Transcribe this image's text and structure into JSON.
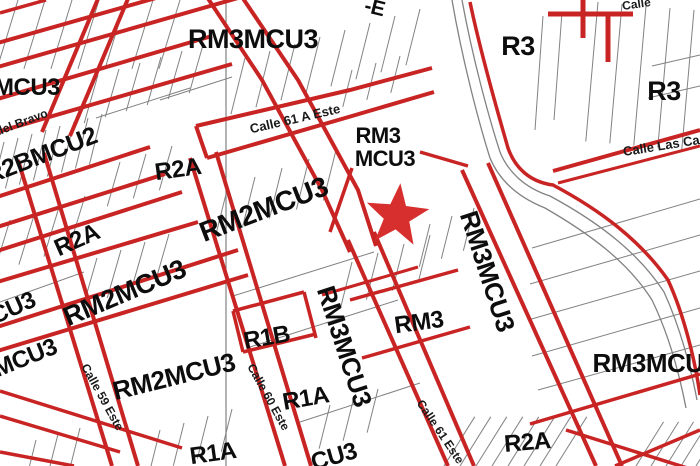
{
  "map": {
    "title": "zoning-parcel-map",
    "colors": {
      "background": "#ffffff",
      "zone_line_red": "#c92424",
      "parcel_line_gray": "#828282",
      "label_black": "#0d0d0d",
      "star_red": "#d62f2d"
    },
    "marker": {
      "name": "star-marker",
      "cx": 397,
      "cy": 216,
      "outer_r": 33,
      "inner_r": 13.5,
      "rotation": 6
    },
    "labels": [
      {
        "id": "rm3mcu3-top",
        "text": "RM3MCU3",
        "x": 253,
        "y": 48,
        "rot": 0,
        "size": 27,
        "kind": "zone"
      },
      {
        "id": "r3-top",
        "text": "R3",
        "x": 518,
        "y": 55,
        "rot": 0,
        "size": 27,
        "kind": "zone"
      },
      {
        "id": "r3-right",
        "text": "R3",
        "x": 664,
        "y": 100,
        "rot": 0,
        "size": 27,
        "kind": "zone"
      },
      {
        "id": "mcu3-topleft",
        "text": "MCU3",
        "x": 27,
        "y": 95,
        "rot": 0,
        "size": 24,
        "kind": "zone"
      },
      {
        "id": "r2bmcu2",
        "text": "R2BMCU2",
        "x": 44,
        "y": 163,
        "rot": -21,
        "size": 25,
        "kind": "zone"
      },
      {
        "id": "rm3-line1",
        "text": "RM3",
        "x": 378,
        "y": 143,
        "rot": 0,
        "size": 22,
        "kind": "zone"
      },
      {
        "id": "mcu3-line2",
        "text": "MCU3",
        "x": 385,
        "y": 166,
        "rot": 0,
        "size": 22,
        "kind": "zone"
      },
      {
        "id": "r2a-upper",
        "text": "R2A",
        "x": 179,
        "y": 177,
        "rot": -8,
        "size": 24,
        "kind": "zone"
      },
      {
        "id": "rm2mcu3-upper",
        "text": "RM2MCU3",
        "x": 267,
        "y": 218,
        "rot": -21,
        "size": 28,
        "kind": "zone"
      },
      {
        "id": "r2a-left",
        "text": "R2A",
        "x": 80,
        "y": 247,
        "rot": -24,
        "size": 24,
        "kind": "zone"
      },
      {
        "id": "rm2mcu3-midleft",
        "text": "RM2MCU3",
        "x": 128,
        "y": 301,
        "rot": -23,
        "size": 27,
        "kind": "zone"
      },
      {
        "id": "cu3-left",
        "text": "CU3",
        "x": 16,
        "y": 315,
        "rot": -24,
        "size": 24,
        "kind": "zone"
      },
      {
        "id": "mcu3-left-lower",
        "text": "MCU3",
        "x": 28,
        "y": 365,
        "rot": -22,
        "size": 24,
        "kind": "zone"
      },
      {
        "id": "rm2mcu3-lower",
        "text": "RM2MCU3",
        "x": 176,
        "y": 385,
        "rot": -14,
        "size": 26,
        "kind": "zone"
      },
      {
        "id": "r1b",
        "text": "R1B",
        "x": 268,
        "y": 345,
        "rot": -10,
        "size": 24,
        "kind": "zone"
      },
      {
        "id": "rm3mcu3-vert-left",
        "text": "RM3MCU3",
        "x": 336,
        "y": 349,
        "rot": 72,
        "size": 26,
        "kind": "zone"
      },
      {
        "id": "rm3mcu3-vert-right",
        "text": "RM3MCU3",
        "x": 479,
        "y": 274,
        "rot": 72,
        "size": 26,
        "kind": "zone"
      },
      {
        "id": "rm3-mid",
        "text": "RM3",
        "x": 420,
        "y": 330,
        "rot": -8,
        "size": 24,
        "kind": "zone"
      },
      {
        "id": "r1a-mid",
        "text": "R1A",
        "x": 307,
        "y": 406,
        "rot": -10,
        "size": 24,
        "kind": "zone"
      },
      {
        "id": "r1a-bottom",
        "text": "R1A",
        "x": 214,
        "y": 461,
        "rot": -8,
        "size": 24,
        "kind": "zone"
      },
      {
        "id": "rm3mcu3-right",
        "text": "RM3MCU3",
        "x": 655,
        "y": 372,
        "rot": 0,
        "size": 26,
        "kind": "zone"
      },
      {
        "id": "r2a-bottomright",
        "text": "R2A",
        "x": 528,
        "y": 450,
        "rot": -5,
        "size": 24,
        "kind": "zone"
      },
      {
        "id": "cu3-bottom",
        "text": "CU3",
        "x": 336,
        "y": 464,
        "rot": -16,
        "size": 24,
        "kind": "zone"
      },
      {
        "id": "e-top-partial",
        "text": "-E",
        "x": 373,
        "y": 14,
        "rot": 14,
        "size": 21,
        "kind": "zone"
      },
      {
        "id": "del-bravo",
        "text": "del Bravo",
        "x": 23,
        "y": 126,
        "rot": -21,
        "size": 12,
        "kind": "street"
      },
      {
        "id": "calle-61a-este",
        "text": "Calle 61 A Este",
        "x": 296,
        "y": 123,
        "rot": -13,
        "size": 13,
        "kind": "street"
      },
      {
        "id": "calle-las",
        "text": "Calle Las Ca",
        "x": 662,
        "y": 150,
        "rot": -9,
        "size": 13,
        "kind": "street"
      },
      {
        "id": "calle-top-partial",
        "text": "Calle",
        "x": 637,
        "y": 8,
        "rot": -8,
        "size": 12,
        "kind": "street"
      },
      {
        "id": "calle-59-este",
        "text": "Calle 59 Este",
        "x": 99,
        "y": 399,
        "rot": 61,
        "size": 12,
        "kind": "street"
      },
      {
        "id": "calle-60-este",
        "text": "Calle 60 Este",
        "x": 265,
        "y": 399,
        "rot": 61,
        "size": 12,
        "kind": "street"
      },
      {
        "id": "calle-61-este",
        "text": "Calle 61 Este",
        "x": 437,
        "y": 434,
        "rot": 56,
        "size": 12,
        "kind": "street"
      }
    ],
    "geometry": {
      "red_segments": [
        [
          -6,
          44,
          170,
          -6,
          4
        ],
        [
          -6,
          68,
          238,
          -2,
          4
        ],
        [
          100,
          -6,
          42,
          132,
          4
        ],
        [
          130,
          -6,
          70,
          136,
          4
        ],
        [
          -6,
          100,
          212,
          36,
          4
        ],
        [
          -6,
          133,
          232,
          64,
          4
        ],
        [
          196,
          126,
          207,
          158,
          4
        ],
        [
          -6,
          198,
          150,
          147,
          4
        ],
        [
          -6,
          228,
          165,
          174,
          4
        ],
        [
          -6,
          252,
          182,
          192,
          4
        ],
        [
          -6,
          283,
          198,
          222,
          4
        ],
        [
          -6,
          328,
          238,
          250,
          4
        ],
        [
          -6,
          352,
          248,
          275,
          4
        ],
        [
          18,
          160,
          112,
          466,
          4
        ],
        [
          44,
          153,
          138,
          466,
          4
        ],
        [
          190,
          158,
          285,
          466,
          4
        ],
        [
          216,
          152,
          311,
          466,
          4
        ],
        [
          348,
          240,
          448,
          466,
          4
        ],
        [
          374,
          232,
          474,
          466,
          4
        ],
        [
          462,
          170,
          596,
          466,
          4
        ],
        [
          488,
          163,
          622,
          466,
          4
        ],
        [
          553,
          171,
          700,
          130,
          4
        ],
        [
          558,
          183,
          700,
          146,
          3
        ],
        [
          548,
          14,
          633,
          14,
          5
        ],
        [
          583,
          -5,
          583,
          38,
          5
        ],
        [
          608,
          14,
          608,
          62,
          5
        ],
        [
          0,
          13,
          46,
          0,
          3.5
        ],
        [
          420,
          152,
          468,
          166,
          3.5
        ],
        [
          352,
          168,
          330,
          232,
          3.5
        ],
        [
          322,
          295,
          418,
          267,
          3
        ],
        [
          350,
          300,
          458,
          270,
          3.5
        ],
        [
          362,
          358,
          470,
          327,
          3.5
        ],
        [
          233,
          311,
          304,
          292,
          3.5
        ],
        [
          304,
          292,
          316,
          338,
          3.5
        ],
        [
          243,
          352,
          316,
          334,
          3.5
        ],
        [
          233,
          311,
          243,
          352,
          3.5
        ],
        [
          0,
          391,
          182,
          448,
          3.5
        ],
        [
          0,
          416,
          120,
          452,
          3.5
        ],
        [
          0,
          452,
          74,
          466,
          3.5
        ],
        [
          566,
          430,
          700,
          472,
          3.5
        ],
        [
          615,
          466,
          700,
          430,
          3.5
        ],
        [
          530,
          424,
          700,
          374,
          3.5
        ]
      ],
      "red_paths": [
        {
          "d": "M205,-6 L262,80 L322,190 L350,252",
          "w": 4
        },
        {
          "d": "M240,-6 L298,80 L358,190 L376,246",
          "w": 4
        },
        {
          "d": "M196,126 L350,90 L432,68",
          "w": 4
        },
        {
          "d": "M207,158 L352,116 L434,92",
          "w": 4
        },
        {
          "d": "M470,2 C480,50 497,110 508,148 C515,168 530,182 553,185 C600,210 640,240 668,280 C684,315 695,360 700,395",
          "w": 3.5
        }
      ],
      "gray_segments": [
        [
          226,
          0,
          226,
          466,
          1.2
        ],
        [
          0,
          302,
          84,
          272,
          1
        ],
        [
          233,
          296,
          374,
          252,
          1
        ],
        [
          250,
          347,
          398,
          300,
          1
        ],
        [
          300,
          422,
          420,
          383,
          1
        ],
        [
          160,
          100,
          232,
          77,
          1
        ],
        [
          96,
          118,
          190,
          88,
          1
        ],
        [
          532,
          248,
          700,
          199,
          1
        ],
        [
          530,
          284,
          700,
          235,
          1
        ],
        [
          528,
          320,
          700,
          271,
          1
        ],
        [
          532,
          356,
          700,
          308,
          1
        ],
        [
          538,
          390,
          700,
          345,
          1
        ],
        [
          652,
          66,
          700,
          55,
          1
        ],
        [
          648,
          98,
          700,
          86,
          1
        ],
        [
          543,
          16,
          535,
          130,
          1
        ],
        [
          562,
          12,
          554,
          120,
          1
        ]
      ],
      "gray_paths": [
        {
          "d": "M462,0 C472,55 488,115 500,152 C508,172 525,188 550,196 C598,222 638,252 664,292 C680,327 691,368 697,400",
          "w": 1.3
        },
        {
          "d": "M452,0 C462,58 478,120 490,158 C500,182 520,198 545,208 C590,234 628,262 652,300 C668,333 679,372 686,408",
          "w": 1.3
        }
      ],
      "hatch_groups": [
        {
          "x": 18,
          "y": 0,
          "sx": 27,
          "sy": 0,
          "n": 7,
          "angle": 107,
          "len": 72
        },
        {
          "x": 245,
          "y": 58,
          "sx": 25,
          "sy": -7,
          "n": 8,
          "angle": 104,
          "len": 58
        },
        {
          "x": 98,
          "y": 75,
          "sx": 21,
          "sy": -6,
          "n": 6,
          "angle": 106,
          "len": 50
        },
        {
          "x": 4,
          "y": 142,
          "sx": 14,
          "sy": -4,
          "n": 8,
          "angle": 104,
          "len": 52
        },
        {
          "x": 10,
          "y": 220,
          "sx": 25,
          "sy": -8,
          "n": 4,
          "angle": 107,
          "len": 55
        },
        {
          "x": 97,
          "y": 258,
          "sx": 24,
          "sy": -8,
          "n": 4,
          "angle": 106,
          "len": 50
        },
        {
          "x": 228,
          "y": 186,
          "sx": 27,
          "sy": -9,
          "n": 5,
          "angle": 104,
          "len": 52
        },
        {
          "x": 352,
          "y": 262,
          "sx": 26,
          "sy": -9,
          "n": 4,
          "angle": 104,
          "len": 48
        },
        {
          "x": 430,
          "y": 224,
          "sx": 22,
          "sy": -8,
          "n": 3,
          "angle": 104,
          "len": 44
        },
        {
          "x": 598,
          "y": 2,
          "sx": 24,
          "sy": 2,
          "n": 5,
          "angle": 95,
          "len": 140
        },
        {
          "x": 444,
          "y": 466,
          "sx": 16,
          "sy": 0,
          "n": 8,
          "angle": -58,
          "len": 58
        },
        {
          "x": 636,
          "y": 466,
          "sx": 15,
          "sy": 0,
          "n": 5,
          "angle": -58,
          "len": 52
        },
        {
          "x": 160,
          "y": 430,
          "sx": 24,
          "sy": -7,
          "n": 4,
          "angle": 104,
          "len": 44
        },
        {
          "x": 36,
          "y": 440,
          "sx": 22,
          "sy": -6,
          "n": 3,
          "angle": 104,
          "len": 40
        },
        {
          "x": 352,
          "y": 70,
          "sx": 24,
          "sy": -7,
          "n": 3,
          "angle": 104,
          "len": 38
        },
        {
          "x": 120,
          "y": 162,
          "sx": 26,
          "sy": -8,
          "n": 3,
          "angle": 106,
          "len": 46
        },
        {
          "x": 330,
          "y": 405,
          "sx": 24,
          "sy": -8,
          "n": 3,
          "angle": 104,
          "len": 45
        }
      ]
    }
  }
}
